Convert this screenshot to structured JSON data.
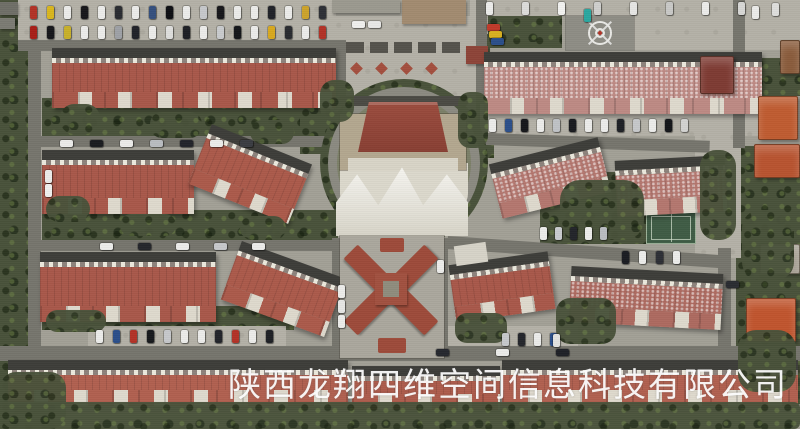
{
  "watermark": {
    "text": "陕西龙翔四维空间信息科技有限公司"
  },
  "scene": {
    "size": {
      "w": 800,
      "h": 429
    },
    "palette": {
      "base": "#a2a096",
      "veg": "#49523a",
      "road": "#76756d",
      "pave": "#b4b1a7",
      "roof_dark_strip": "#3d3d39",
      "wall_white": "#ded9cd",
      "tent_white": "#ecebe4",
      "ring_road": "#8b8a81",
      "circle_inner": "#7c8068",
      "clubhouse_tan": "#b3a78f",
      "watermark_color": "rgba(255,255,255,0.92)"
    },
    "vegetation": [
      [
        0,
        0,
        30,
        429
      ],
      [
        26,
        0,
        306,
        4
      ],
      [
        26,
        21,
        306,
        4
      ],
      [
        42,
        98,
        296,
        40
      ],
      [
        42,
        210,
        296,
        32
      ],
      [
        42,
        306,
        252,
        24
      ],
      [
        488,
        16,
        74,
        32
      ],
      [
        638,
        16,
        118,
        32
      ],
      [
        464,
        34,
        26,
        76
      ],
      [
        540,
        172,
        106,
        72
      ],
      [
        736,
        146,
        64,
        258
      ],
      [
        754,
        58,
        46,
        38
      ],
      [
        300,
        88,
        40,
        66
      ],
      [
        464,
        96,
        30,
        62
      ],
      [
        492,
        114,
        258,
        7
      ]
    ],
    "pavement": [
      [
        18,
        0,
        318,
        44
      ],
      [
        330,
        16,
        146,
        94
      ],
      [
        470,
        0,
        330,
        16
      ],
      [
        620,
        0,
        180,
        50
      ],
      [
        480,
        102,
        290,
        34
      ],
      [
        88,
        326,
        198,
        22
      ],
      [
        428,
        326,
        150,
        26
      ],
      [
        695,
        128,
        46,
        130
      ]
    ],
    "roads": [
      [
        18,
        40,
        320,
        11,
        0
      ],
      [
        28,
        40,
        13,
        366,
        0
      ],
      [
        41,
        136,
        300,
        11,
        0
      ],
      [
        41,
        240,
        300,
        11,
        0
      ],
      [
        0,
        346,
        800,
        15,
        0
      ],
      [
        476,
        0,
        11,
        104,
        0
      ],
      [
        458,
        132,
        252,
        12,
        2
      ],
      [
        733,
        0,
        12,
        148,
        0
      ],
      [
        448,
        236,
        274,
        13,
        4
      ],
      [
        718,
        248,
        13,
        102,
        0
      ],
      [
        334,
        40,
        12,
        72,
        0
      ],
      [
        332,
        238,
        12,
        112,
        0
      ],
      [
        436,
        238,
        12,
        112,
        0
      ]
    ],
    "blocks": [
      [
        0,
        2,
        18,
        13,
        "#6f6f67",
        "small-building"
      ],
      [
        0,
        18,
        15,
        11,
        "#7b7b73",
        "small-building"
      ],
      [
        402,
        0,
        64,
        24,
        "#a28b70",
        "flat-roof-building"
      ],
      [
        332,
        0,
        68,
        13,
        "#9b998f",
        "flat-roof-building"
      ],
      [
        466,
        46,
        22,
        18,
        "#8d4438",
        "gatehouse-roof"
      ]
    ],
    "buildings": [
      [
        52,
        48,
        284,
        60,
        0,
        "#a8584a",
        0
      ],
      [
        42,
        150,
        152,
        64,
        0,
        "#a8584a",
        0
      ],
      [
        196,
        142,
        108,
        64,
        22,
        "#ab5a4b",
        0
      ],
      [
        40,
        252,
        176,
        70,
        0,
        "#a8584a",
        0
      ],
      [
        228,
        258,
        110,
        62,
        20,
        "#ab5a4b",
        0
      ],
      [
        8,
        360,
        340,
        46,
        0,
        "#b06050",
        0
      ],
      [
        352,
        366,
        148,
        44,
        0,
        "#ad5c4c",
        0
      ],
      [
        502,
        360,
        296,
        46,
        0,
        "#b06050",
        0
      ],
      [
        484,
        52,
        278,
        62,
        0,
        "#bd8a84",
        1
      ],
      [
        494,
        150,
        112,
        56,
        -14,
        "#b4776f",
        1
      ],
      [
        616,
        158,
        110,
        56,
        -3,
        "#b4776f",
        1
      ],
      [
        570,
        270,
        152,
        56,
        3,
        "#ad6a60",
        1
      ],
      [
        452,
        258,
        100,
        58,
        -8,
        "#a8584a",
        0
      ]
    ],
    "villas": [
      [
        700,
        56,
        34,
        38,
        "#7e3b33"
      ],
      [
        780,
        40,
        20,
        34,
        "#8a5c3c"
      ],
      [
        758,
        96,
        40,
        44,
        "#bf5c31"
      ],
      [
        754,
        144,
        46,
        34,
        "#b85430"
      ],
      [
        760,
        244,
        40,
        30,
        "#a9a296"
      ],
      [
        746,
        298,
        50,
        44,
        "#c0552e"
      ]
    ],
    "circle": {
      "cx": 404,
      "cy": 163,
      "r_outer": 84,
      "r_ring": 76,
      "ring_width": 9,
      "carport": [
        338,
        96,
        130,
        10
      ],
      "base": [
        340,
        114,
        126,
        56
      ],
      "terrace": [
        348,
        158,
        110,
        13
      ],
      "roof": [
        358,
        102,
        90,
        50
      ],
      "apron": [
        340,
        163,
        128,
        66
      ],
      "tents": [
        336,
        166,
        132,
        70
      ],
      "gates": [
        [
          364,
          236,
          24,
          17
        ],
        [
          398,
          236,
          24,
          17
        ]
      ]
    },
    "plaza": {
      "canopy": [
        346,
        42,
        116,
        11
      ],
      "diamonds_y": 64,
      "diamonds_x": [
        352,
        377,
        402,
        427
      ]
    },
    "helipad": {
      "pad": [
        566,
        16,
        68,
        34
      ],
      "cx": 600,
      "cy": 33
    },
    "court": [
      646,
      212,
      50,
      32
    ],
    "ornate": {
      "base": [
        340,
        236,
        104,
        122
      ],
      "roof": "#9d4b3a",
      "arm_w": 52,
      "arm_h": 20,
      "arms": [
        [
          343,
          260,
          45
        ],
        [
          387,
          260,
          -45
        ],
        [
          343,
          300,
          -45
        ],
        [
          387,
          300,
          45
        ]
      ],
      "center": [
        375,
        273,
        32,
        32
      ],
      "courtyard": [
        383,
        281,
        16,
        16
      ],
      "tips": [
        [
          380,
          238,
          24,
          14
        ],
        [
          378,
          338,
          28,
          15
        ]
      ],
      "white_block": [
        455,
        244,
        32,
        20
      ]
    },
    "vegetation_over": [
      [
        0,
        402,
        800,
        27,
        6
      ],
      [
        46,
        196,
        44,
        26,
        14
      ],
      [
        120,
        214,
        56,
        22,
        12
      ],
      [
        240,
        216,
        46,
        24,
        12
      ],
      [
        60,
        104,
        40,
        30,
        14
      ],
      [
        150,
        112,
        52,
        26,
        12
      ],
      [
        250,
        120,
        44,
        24,
        12
      ],
      [
        46,
        310,
        60,
        22,
        12
      ],
      [
        560,
        180,
        84,
        60,
        20
      ],
      [
        700,
        150,
        36,
        90,
        16
      ],
      [
        742,
        210,
        52,
        70,
        18
      ],
      [
        738,
        330,
        58,
        62,
        18
      ],
      [
        0,
        372,
        66,
        57,
        16
      ],
      [
        320,
        80,
        34,
        42,
        14
      ],
      [
        458,
        92,
        30,
        56,
        12
      ],
      [
        455,
        313,
        52,
        30,
        12
      ],
      [
        556,
        298,
        60,
        46,
        14
      ]
    ],
    "car_rows": [
      {
        "x": 30,
        "y": 6,
        "dx": 17,
        "o": "v",
        "colors": [
          "#b23227",
          "#d9b61e",
          "#ececea",
          "#17171b",
          "#ececea",
          "#2a2c31",
          "#ececea",
          "#35507e",
          "#0e0f13",
          "#ececea",
          "#c6c8cb",
          "#17171b",
          "#ececea",
          "#ececea",
          "#212329",
          "#ececea",
          "#cda32b",
          "#2e3036"
        ]
      },
      {
        "x": 30,
        "y": 26,
        "dx": 17,
        "o": "v",
        "colors": [
          "#a81f18",
          "#17171b",
          "#c8b02a",
          "#ececea",
          "#ececea",
          "#9ea1a6",
          "#212329",
          "#ececea",
          "#dededc",
          "#1e2025",
          "#ececea",
          "#c9cbcd",
          "#14161a",
          "#ececea",
          "#d8a91f",
          "#2a2c30",
          "#ececea",
          "#b23227"
        ]
      },
      {
        "x": 486,
        "y": 2,
        "dx": 36,
        "o": "v",
        "colors": [
          "#ececea",
          "#dcdcda",
          "#f2f2f0",
          "#cfcfcd",
          "#e6e6e4",
          "#c9c9c7",
          "#ececea",
          "#d7d7d5"
        ]
      },
      {
        "x": 489,
        "y": 119,
        "dx": 16,
        "o": "v",
        "colors": [
          "#ececea",
          "#2b4f8a",
          "#15171b",
          "#ececea",
          "#bfc2c6",
          "#191b1f",
          "#ececea",
          "#ececea",
          "#1f2126",
          "#c6c8ca",
          "#ececea",
          "#14161a",
          "#d2d2d0"
        ]
      },
      {
        "x": 60,
        "y": 140,
        "dx": 30,
        "o": "h",
        "colors": [
          "#ececea",
          "#1a1c20",
          "#ececea",
          "#b9bcc0",
          "#22242a",
          "#ececea",
          "#3a3c42"
        ]
      },
      {
        "x": 100,
        "y": 243,
        "dx": 38,
        "o": "h",
        "colors": [
          "#ececea",
          "#24262b",
          "#ececea",
          "#c6c8cb",
          "#ececea"
        ]
      },
      {
        "x": 96,
        "y": 330,
        "dx": 17,
        "o": "v",
        "colors": [
          "#ececea",
          "#2b4f8a",
          "#b23227",
          "#17191d",
          "#c6c8cb",
          "#ececea",
          "#ececea",
          "#22242a",
          "#b23227",
          "#ececea",
          "#1e2025"
        ]
      },
      {
        "x": 540,
        "y": 227,
        "dx": 15,
        "o": "v",
        "colors": [
          "#ececea",
          "#c9cbce",
          "#23252a",
          "#ececea",
          "#b9bcc0"
        ]
      },
      {
        "x": 622,
        "y": 251,
        "dx": 17,
        "o": "v",
        "colors": [
          "#1b1d22",
          "#ececea",
          "#2d2f35",
          "#ececea"
        ]
      },
      {
        "x": 436,
        "y": 349,
        "dx": 60,
        "o": "h",
        "colors": [
          "#26282e",
          "#ececea",
          "#1f2127"
        ]
      },
      {
        "x": 352,
        "y": 21,
        "dx": 16,
        "o": "h",
        "colors": [
          "#f0f0ee",
          "#e8e8e6"
        ]
      },
      {
        "x": 502,
        "y": 333,
        "dx": 16,
        "o": "v",
        "colors": [
          "#c6c8cb",
          "#24262b",
          "#ececea",
          "#2b4f8a"
        ]
      }
    ],
    "cars": [
      [
        584,
        9,
        "v",
        "#2aa7a0"
      ],
      [
        487,
        24,
        "h",
        "#c03a2a"
      ],
      [
        489,
        31,
        "h",
        "#d8b021"
      ],
      [
        491,
        38,
        "h",
        "#2b4f8a"
      ],
      [
        726,
        281,
        "h",
        "#2a2c31"
      ],
      [
        752,
        6,
        "v",
        "#ececea"
      ],
      [
        772,
        3,
        "v",
        "#dededc"
      ],
      [
        45,
        170,
        "v",
        "#ececea"
      ],
      [
        45,
        184,
        "v",
        "#f0f0ee"
      ],
      [
        338,
        285,
        "v",
        "#ececea"
      ],
      [
        338,
        300,
        "v",
        "#e6e6e4"
      ],
      [
        338,
        315,
        "v",
        "#ececea"
      ],
      [
        437,
        260,
        "v",
        "#ececea"
      ],
      [
        553,
        334,
        "v",
        "#e2e2e0"
      ]
    ]
  }
}
